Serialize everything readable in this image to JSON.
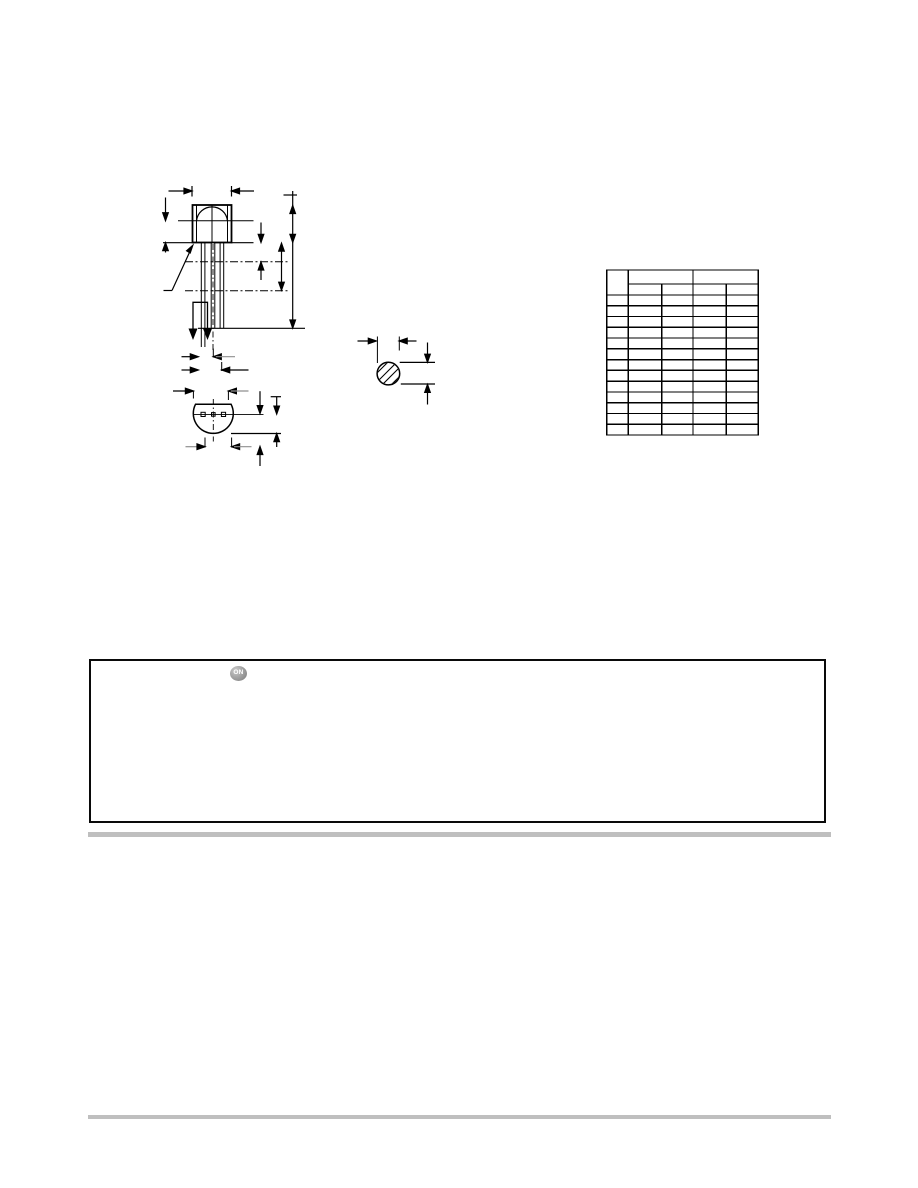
{
  "page": {
    "type": "datasheet-package-dimensions-page",
    "background_color": "#ffffff"
  },
  "logo": {
    "text": "ON"
  },
  "colors": {
    "line": "#000000",
    "divider_gray": "#bfbfbf",
    "dim_tail_gray": "#8f8f8f",
    "logo_gray": "#9a9a9a"
  },
  "drawing": {
    "views": [
      "front-view",
      "bottom-view",
      "lead-section-view"
    ],
    "visible_text": ""
  },
  "dimension_table": {
    "visible_text": "",
    "column_count": 5,
    "header_row_count": 2,
    "data_row_count": 13,
    "x_left": 606.7,
    "x_cols": [
      628.3,
      661.7,
      693.0,
      726.3
    ],
    "x_right": 758.3,
    "y_top": 270,
    "y_group_header_bottom": 284,
    "y_sub_header_bottom": 295,
    "y_bottom": 435
  },
  "notice_box": {
    "visible_text": ""
  }
}
